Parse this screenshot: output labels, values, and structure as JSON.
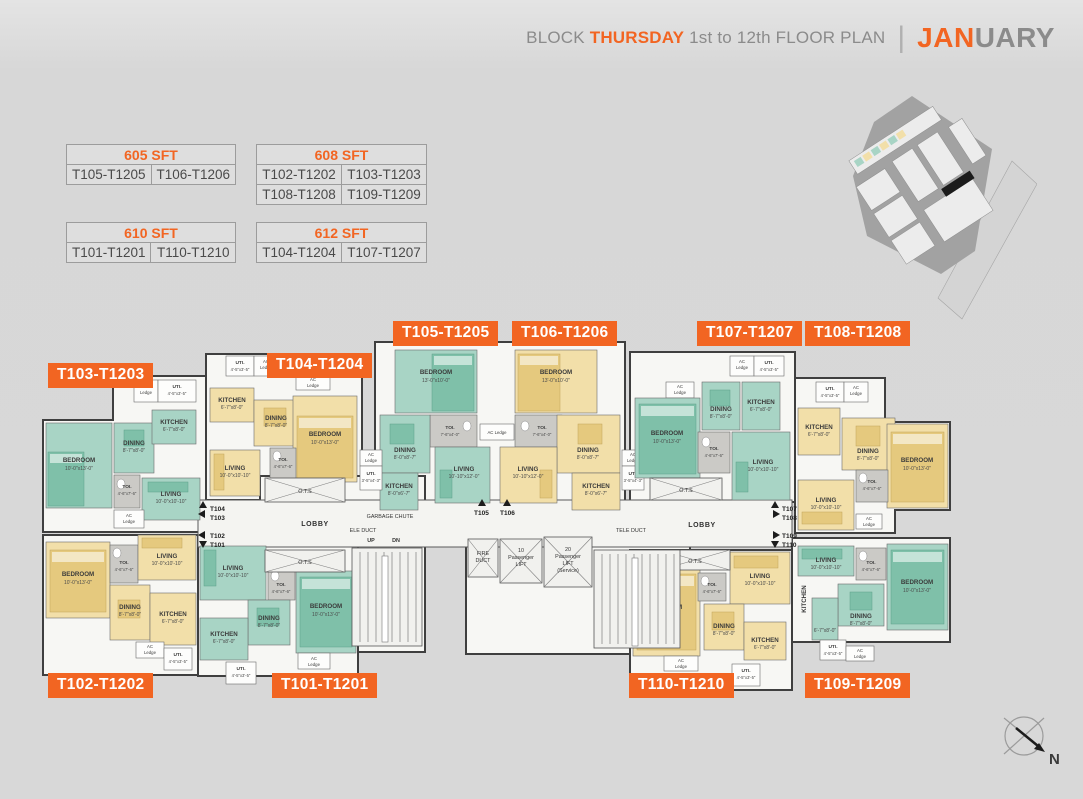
{
  "header": {
    "block_label": "BLOCK ",
    "block_name": "THURSDAY",
    "floor_text": " 1st to 12th FLOOR PLAN",
    "divider": "|",
    "month_accent": "JAN",
    "month_rest": "UARY"
  },
  "area_tables": [
    {
      "title": "605 SFT",
      "rows": [
        [
          "T105-T1205",
          "T106-T1206"
        ]
      ]
    },
    {
      "title": "608 SFT",
      "rows": [
        [
          "T102-T1202",
          "T103-T1203"
        ],
        [
          "T108-T1208",
          "T109-T1209"
        ]
      ]
    },
    {
      "title": "610 SFT",
      "rows": [
        [
          "T101-T1201",
          "T110-T1210"
        ]
      ]
    },
    {
      "title": "612 SFT",
      "rows": [
        [
          "T104-T1204",
          "T107-T1207"
        ]
      ]
    }
  ],
  "badges": {
    "t103": "T103-T1203",
    "t104": "T104-T1204",
    "t105": "T105-T1205",
    "t106": "T106-T1206",
    "t107": "T107-T1207",
    "t108": "T108-T1208",
    "t102": "T102-T1202",
    "t101": "T101-T1201",
    "t110": "T110-T1210",
    "t109": "T109-T1209"
  },
  "plan": {
    "rooms": {
      "bedroom": {
        "name": "BEDROOM",
        "dim": "10'-0\"x13'-0\""
      },
      "bedroom_c": {
        "name": "BEDROOM",
        "dim": "13'-0\"x10'-0\""
      },
      "dining": {
        "name": "DINING",
        "dim": "8'-7\"x8'-0\""
      },
      "dining_c": {
        "name": "DINING",
        "dim": "8'-0\"x8'-7\""
      },
      "kitchen": {
        "name": "KITCHEN",
        "dim": "6'-7\"x8'-0\""
      },
      "kitchen_c": {
        "name": "KITCHEN",
        "dim": "8'-0\"x6'-7\""
      },
      "living": {
        "name": "LIVING",
        "dim": "10'-0\"x10'-10\""
      },
      "living_c": {
        "name": "LIVING",
        "dim": "10'-10\"x12'-0\""
      },
      "toi": {
        "name": "TOI.",
        "dim": "4'-6\"x7'-6\""
      },
      "toi_c": {
        "name": "TOI.",
        "dim": "7'-6\"x4'-0\""
      },
      "uti": {
        "name": "UTI.",
        "dim": "4'-5\"x3'-5\""
      },
      "uti_c": {
        "name": "UTI.",
        "dim": "3'-5\"x4'-3\""
      }
    },
    "labels": {
      "lobby": "LOBBY",
      "ots": "O.T.S",
      "garbage": "GARBAGE CHUTE",
      "ele_duct": "ELE DUCT",
      "tele_duct": "TELE DUCT",
      "fire_l1": "FIRE",
      "fire_l2": "DUCT",
      "lift10": [
        "10",
        "Passenger",
        "LIFT"
      ],
      "lift20": [
        "20",
        "Passenger",
        "LIFT",
        "(Service)"
      ],
      "up": "UP",
      "dn": "DN",
      "ac": "AC",
      "ledge": "Ledge",
      "ac_ledge": "AC Ledge"
    },
    "entries": {
      "t101": "T101",
      "t102": "T102",
      "t103": "T103",
      "t104": "T104",
      "t105": "T105",
      "t106": "T106",
      "t107": "T107",
      "t108": "T108",
      "t109": "T109",
      "t110": "T110"
    }
  },
  "compass": {
    "north": "N"
  },
  "colors": {
    "accent": "#f26522",
    "teal": "#a8d4c5",
    "cream": "#f2dfa9",
    "toilet": "#cbcac6",
    "wall": "#3f3f3f",
    "background": "#d8d8d8"
  }
}
